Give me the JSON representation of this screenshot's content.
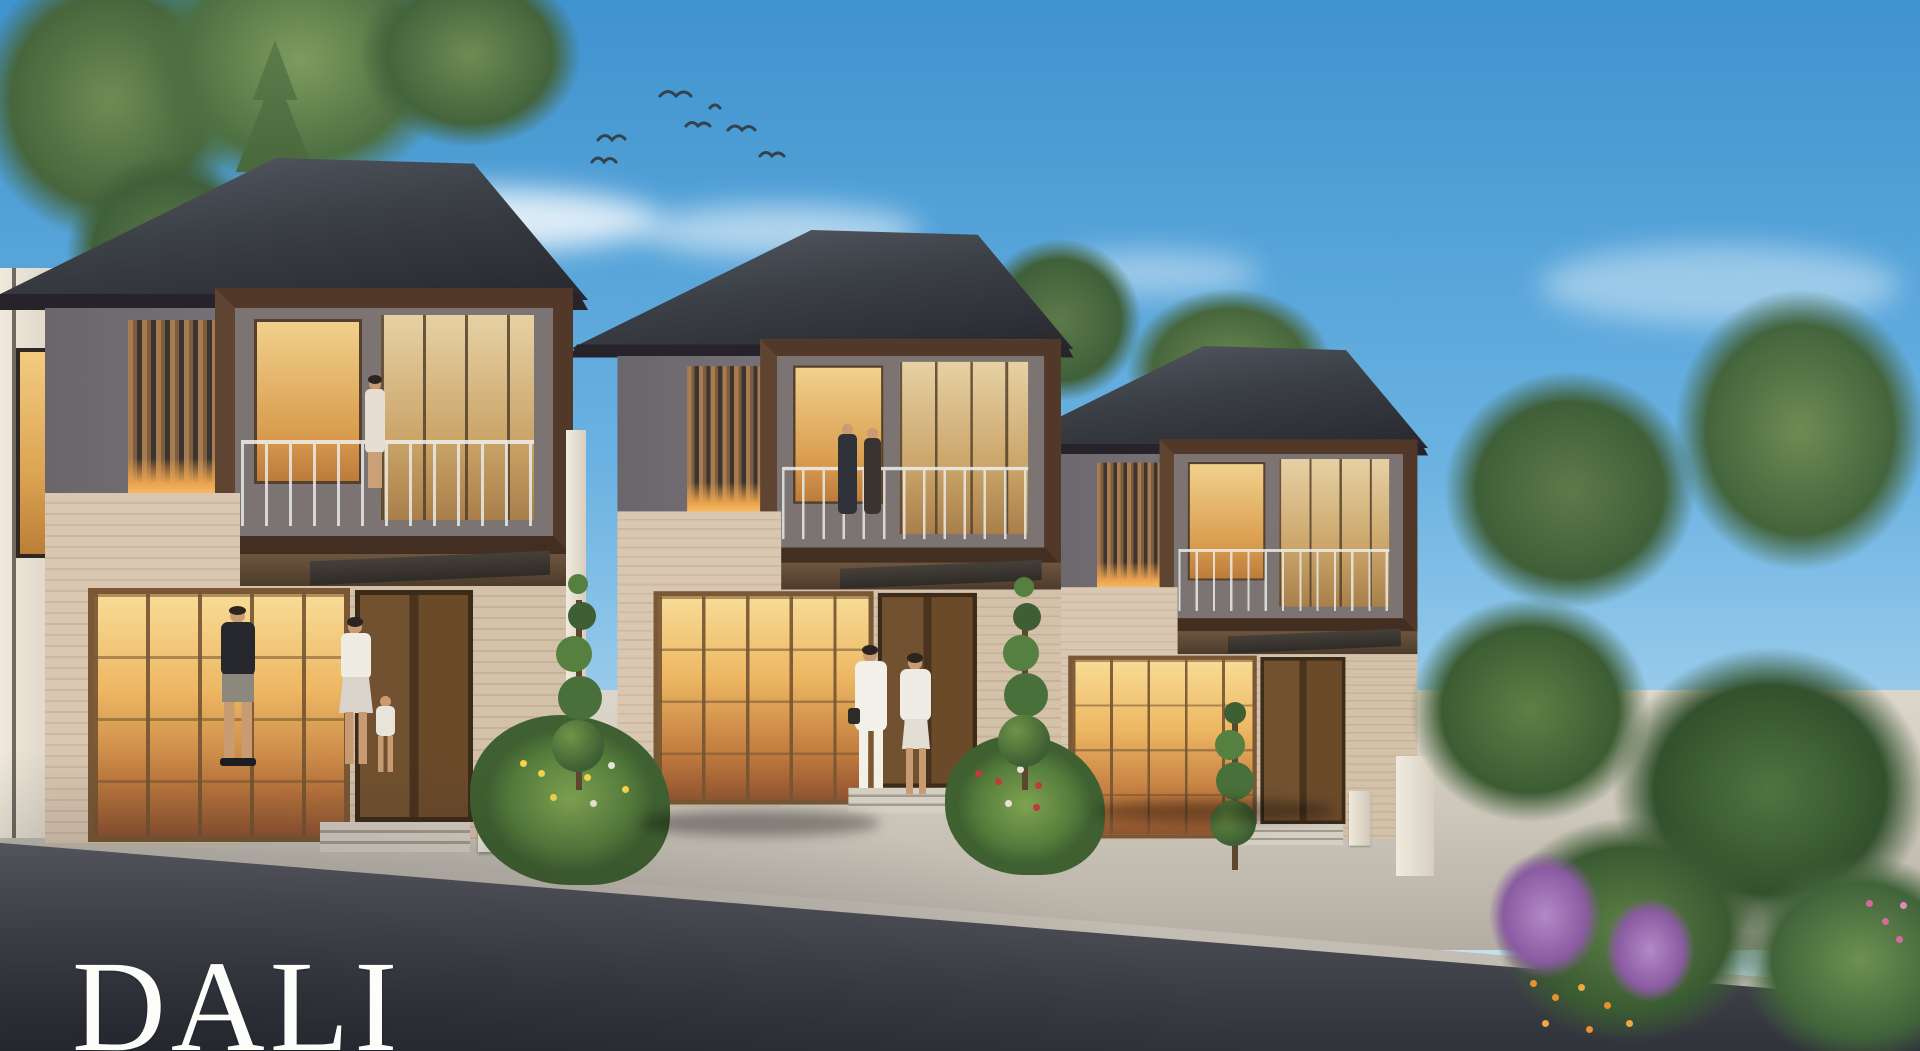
{
  "brand": {
    "wordmark": "DALI"
  },
  "scene": {
    "description": "Dusk architectural rendering of a row of three modern two-storey tropical houses with dark hip roofs, timber slat screens, box balconies, warm-lit glazing, residents walking, a red SUV and a white hatchback parked on driveways, landscaped gardens and birds in a blue sky",
    "elements": [
      "house-left",
      "house-middle",
      "house-right",
      "red-suv",
      "white-hatchback",
      "man-walking",
      "woman-with-child",
      "two-women-walking",
      "balcony-woman",
      "balcony-couple",
      "spiral-topiary-trees",
      "flower-beds",
      "purple-flower-bush",
      "orange-flowers",
      "pine-tree",
      "leafy-trees",
      "flying-birds",
      "clouds",
      "road",
      "sidewalk",
      "lamp-posts"
    ],
    "colors": {
      "sky_top": "#3f93cf",
      "sky_horizon": "#cfe6f2",
      "roof": "#3c4047",
      "balcony_frame": "#513828",
      "wood_slat": "#a77c50",
      "warm_window_light": "#edb763",
      "brick_wall": "#d4c1aa",
      "upper_wall_gray": "#6e6a72",
      "concrete": "#cdc7bc",
      "road_asphalt": "#3d3f47",
      "foliage": "#557c3c",
      "flower_purple": "#9a6bb0",
      "flower_orange": "#e8912f",
      "flower_yellow": "#f2d24c",
      "suv_red": "#8c2130",
      "car_white": "#e7e9ec",
      "wordmark_color": "#fdfdfa"
    }
  }
}
